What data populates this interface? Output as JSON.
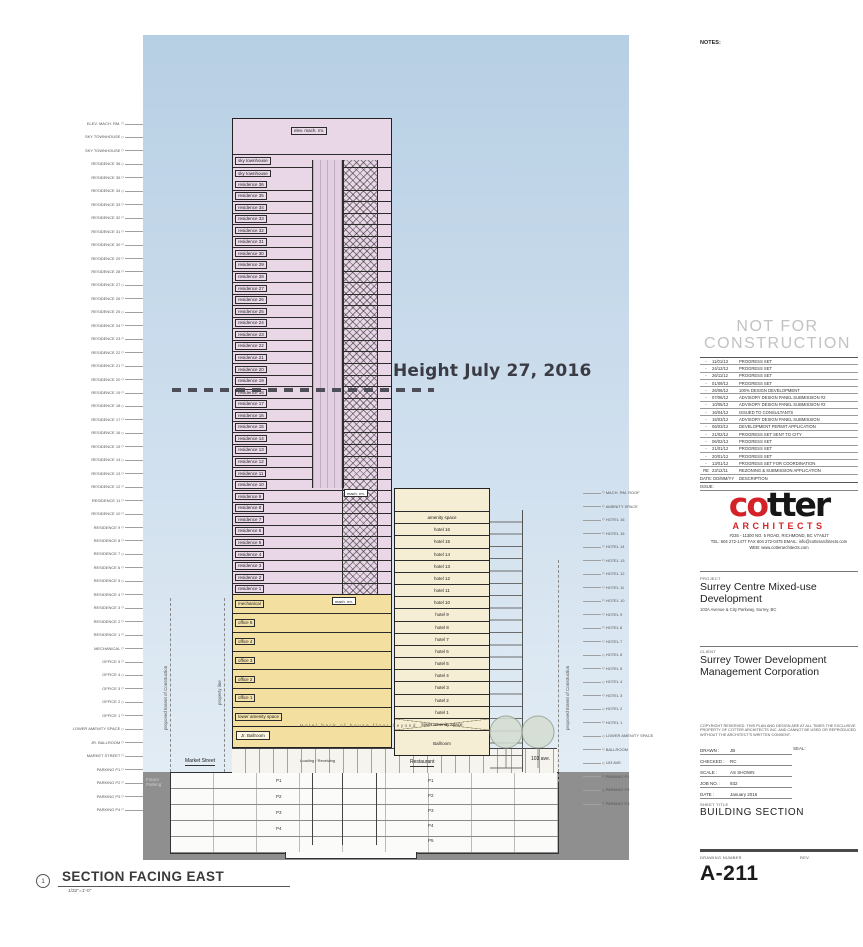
{
  "colors": {
    "logo_red": "#d42328",
    "tower_pink": "#e9d7e7",
    "podium_yellow": "#f3dfa0",
    "hotel_cream": "#f6eed4",
    "sky_top": "#b7cfe4",
    "sky_bottom": "#e2ecf4",
    "ground_gray": "#8f8f8f",
    "nfc_gray": "#c2c2c2"
  },
  "tower": {
    "top_label": "elev. mach. rm.",
    "sky_floors": [
      "sky townhouse",
      "sky townhouse"
    ],
    "floors": [
      "residence 36",
      "residence 35",
      "residence 34",
      "residence 33",
      "residence 32",
      "residence 31",
      "residence 30",
      "residence 29",
      "residence 28",
      "residence 27",
      "residence 26",
      "residence 25",
      "residence 24",
      "residence 23",
      "residence 22",
      "residence 21",
      "residence 20",
      "residence 19",
      "residence 18",
      "residence 17",
      "residence 16",
      "residence 15",
      "residence 14",
      "residence 13",
      "residence 12",
      "residence 11",
      "residence 10",
      "residence 9",
      "residence 8",
      "residence 7",
      "residence 6",
      "residence 5",
      "residence 4",
      "residence 3",
      "residence 2",
      "residence 1"
    ],
    "mach_rm_upper": "mach. rm.",
    "mach_rm_podium": "mach. rm."
  },
  "podium": {
    "floors": [
      "mechanical",
      "office 5",
      "office 4",
      "office 3",
      "office 2",
      "office 1",
      "lower amenity space"
    ],
    "jr_ballroom": "Jr. Ballroom",
    "boh_text": "Hotel back of house floor beyond"
  },
  "hotel": {
    "floors": [
      "amenity space",
      "hotel 16",
      "hotel 15",
      "hotel 14",
      "hotel 13",
      "hotel 12",
      "hotel 11",
      "hotel 10",
      "hotel 9",
      "hotel 8",
      "hotel 7",
      "hotel 6",
      "hotel 5",
      "hotel 4",
      "hotel 3",
      "hotel 2",
      "hotel 1",
      "lower amenity space"
    ],
    "ballroom": "Ballroom",
    "restaurant": "Restaurant"
  },
  "ground": {
    "market_street": "Market Street",
    "loading": "Loading / Receiving",
    "ave": "103 ave.",
    "future_parking": "Future\nParking",
    "parking_left": [
      "P1",
      "P2",
      "P3",
      "P4"
    ],
    "parking_right": [
      "P1",
      "P2",
      "P3",
      "P4",
      "P5"
    ]
  },
  "site_lines": {
    "extent": "proposed Extent of Construction",
    "property": "property line"
  },
  "height_line": {
    "label": "Height July 27, 2016"
  },
  "left_markers": [
    "ELEV. MACH. RM.",
    "SKY TOWNHOUSE",
    "SKY TOWNHOUSE",
    "RESIDENCE 36",
    "RESIDENCE 35",
    "RESIDENCE 34",
    "RESIDENCE 33",
    "RESIDENCE 32",
    "RESIDENCE 31",
    "RESIDENCE 30",
    "RESIDENCE 29",
    "RESIDENCE 28",
    "RESIDENCE 27",
    "RESIDENCE 26",
    "RESIDENCE 25",
    "RESIDENCE 24",
    "RESIDENCE 23",
    "RESIDENCE 22",
    "RESIDENCE 21",
    "RESIDENCE 20",
    "RESIDENCE 19",
    "RESIDENCE 18",
    "RESIDENCE 17",
    "RESIDENCE 16",
    "RESIDENCE 15",
    "RESIDENCE 14",
    "RESIDENCE 13",
    "RESIDENCE 12",
    "RESIDENCE 11",
    "RESIDENCE 10",
    "RESIDENCE 9",
    "RESIDENCE 8",
    "RESIDENCE 7",
    "RESIDENCE 6",
    "RESIDENCE 5",
    "RESIDENCE 4",
    "RESIDENCE 3",
    "RESIDENCE 2",
    "RESIDENCE 1",
    "MECHANICAL",
    "OFFICE 5",
    "OFFICE 4",
    "OFFICE 3",
    "OFFICE 2",
    "OFFICE 1",
    "LOWER AMENITY SPACE",
    "JR. BALLROOM",
    "MARKET STREET",
    "PARKING P1",
    "PARKING P2",
    "PARKING P3",
    "PARKING P4"
  ],
  "right_markers": [
    "MACH. RM. ROOF",
    "AMENITY SPACE",
    "HOTEL 16",
    "HOTEL 15",
    "HOTEL 14",
    "HOTEL 13",
    "HOTEL 12",
    "HOTEL 11",
    "HOTEL 10",
    "HOTEL 9",
    "HOTEL 8",
    "HOTEL 7",
    "HOTEL 6",
    "HOTEL 5",
    "HOTEL 4",
    "HOTEL 3",
    "HOTEL 2",
    "HOTEL 1",
    "LOWER AMENITY SPACE",
    "BALLROOM",
    "103 AVE.",
    "PARKING P1",
    "PARKING P2",
    "PARKING P3"
  ],
  "section_title": {
    "number": "1",
    "title": "SECTION FACING EAST",
    "scale": "1/32\"=1'-0\""
  },
  "titleblock": {
    "notes": "NOTES:",
    "nfc_line1": "NOT FOR",
    "nfc_line2": "CONSTRUCTION",
    "revisions": [
      {
        "rev": "-",
        "date": "11/01/13",
        "desc": "PROGRESS SET"
      },
      {
        "rev": "-",
        "date": "24/12/12",
        "desc": "PROGRESS SET"
      },
      {
        "rev": "-",
        "date": "26/11/12",
        "desc": "PROGRESS SET"
      },
      {
        "rev": "-",
        "date": "01/09/12",
        "desc": "PROGRESS SET"
      },
      {
        "rev": "-",
        "date": "26/06/12",
        "desc": "100% DESIGN DEVELOPMENT"
      },
      {
        "rev": "-",
        "date": "07/06/12",
        "desc": "ADVISORY DESIGN PANEL SUBMISSION #2"
      },
      {
        "rev": "-",
        "date": "10/05/12",
        "desc": "ADVISORY DESIGN PANEL SUBMISSION #2"
      },
      {
        "rev": "-",
        "date": "16/04/12",
        "desc": "ISSUED TO CONSULTANTS"
      },
      {
        "rev": "-",
        "date": "15/03/12",
        "desc": "ADVISORY DESIGN PANEL SUBMISSION"
      },
      {
        "rev": "-",
        "date": "06/03/12",
        "desc": "DEVELOPMENT PERMIT APPLICATION"
      },
      {
        "rev": "-",
        "date": "21/02/12",
        "desc": "PROGRESS SET SENT TO CITY"
      },
      {
        "rev": "-",
        "date": "06/02/12",
        "desc": "PROGRESS SET"
      },
      {
        "rev": "-",
        "date": "21/01/12",
        "desc": "PROGRESS SET"
      },
      {
        "rev": "-",
        "date": "20/01/12",
        "desc": "PROGRESS SET"
      },
      {
        "rev": "-",
        "date": "13/01/12",
        "desc": "PROGRESS SET FOR COORDINATION"
      },
      {
        "rev": "RE",
        "date": "23/12/11",
        "desc": "REZONING & SUBMISSION APPLICATION"
      }
    ],
    "rev_foot_date": "DATE:  DD/MM/YY",
    "rev_foot_desc": "DESCRIPTION",
    "rev_foot_issue": "ISSUE:",
    "logo_part1": "co",
    "logo_part2": "tter",
    "logo_sub": "ARCHITECTS",
    "address1": "#235 - 11300 NO. 5 ROAD, RICHMOND, BC  V7A5J7",
    "address2": "TEL: 604 272-1477   FAX 604 272-0475   EMAIL: info@cotterarchitects.com",
    "address3": "WEB: www.cotterarchitects.com",
    "project_label": "PROJECT",
    "project_name": "Surrey Centre Mixed-use Development",
    "project_address": "103A Avenue & City Parkway, Surrey, BC",
    "client_label": "CLIENT",
    "client_name": "Surrey Tower Development Management Corporation",
    "copyright": "COPYRIGHT RESERVED. THIS PLAN AND DESIGN ARE AT ALL TIMES THE EXCLUSIVE PROPERTY OF COTTER ARCHITECTS INC. AND CANNOT BE USED OR REPRODUCED WITHOUT THE ARCHITECT'S WRITTEN CONSENT.",
    "info": [
      {
        "label": "DRAWN",
        "value": "JB"
      },
      {
        "label": "CHECKED",
        "value": "RC"
      },
      {
        "label": "SCALE",
        "value": "AS SHOWN"
      },
      {
        "label": "JOB NO.",
        "value": "932"
      },
      {
        "label": "DATE",
        "value": "January 2016"
      }
    ],
    "seal_label": "SEAL:",
    "sheet_title_label": "SHEET TITLE",
    "sheet_title": "BUILDING SECTION",
    "drawing_number_label": "DRAWING NUMBER",
    "rev_label": "REV.",
    "drawing_number": "A-211"
  }
}
